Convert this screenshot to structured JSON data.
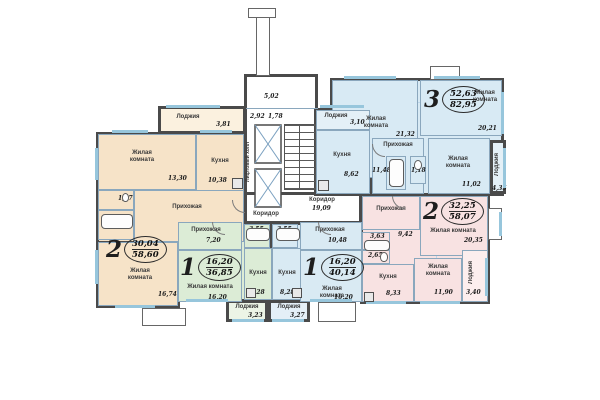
{
  "core": {
    "lift_hall_label": "Лифтовый холл",
    "corridor_left_label": "Коридор",
    "corridor_right_label": "Коридор",
    "corridor_right_area": "19,09",
    "tambour_dims": [
      "5,02",
      "2,92",
      "1,78"
    ]
  },
  "apartments": [
    {
      "key": "orange-2room",
      "badge": "2",
      "living_area": "30,04",
      "total_area": "58,60",
      "rooms": [
        {
          "label": "Лоджия",
          "area": "3,81"
        },
        {
          "label": "Жилая комната",
          "area": "13,30"
        },
        {
          "label": "Кухня",
          "area": "10,38"
        },
        {
          "label": "",
          "area": "1,67"
        },
        {
          "label": "",
          "area": "2,48"
        },
        {
          "label": "Прихожая",
          "area": "11,80"
        },
        {
          "label": "Жилая комната",
          "area": "16,74"
        }
      ]
    },
    {
      "key": "green-1room",
      "badge": "1",
      "living_area": "16,20",
      "total_area": "36,85",
      "rooms": [
        {
          "label": "Прихожая",
          "area": "7,20"
        },
        {
          "label": "Жилая комната",
          "area": "16,20"
        },
        {
          "label": "",
          "area": "3,55"
        },
        {
          "label": "Кухня",
          "area": "8,28"
        },
        {
          "label": "Лоджия",
          "area": "3,23"
        }
      ]
    },
    {
      "key": "blue-1room",
      "badge": "1",
      "living_area": "16,20",
      "total_area": "40,14",
      "rooms": [
        {
          "label": "Прихожая",
          "area": "10,48"
        },
        {
          "label": "Жилая комната",
          "area": "16,20"
        },
        {
          "label": "",
          "area": "3,55"
        },
        {
          "label": "Кухня",
          "area": "8,28"
        },
        {
          "label": "Лоджия",
          "area": "3,27"
        }
      ]
    },
    {
      "key": "top-3room",
      "badge": "3",
      "living_area": "52,63",
      "total_area": "82,95",
      "rooms": [
        {
          "label": "Жилая комната",
          "area": "21,32"
        },
        {
          "label": "Жилая комната",
          "area": "20,21"
        },
        {
          "label": "Жилая комната",
          "area": "11,02"
        },
        {
          "label": "Кухня",
          "area": "8,62"
        },
        {
          "label": "Прихожая",
          "area": "11,48"
        },
        {
          "label": "",
          "area": "4,08"
        },
        {
          "label": "",
          "area": "1,18"
        },
        {
          "label": "Лоджия",
          "area": "3,10"
        },
        {
          "label": "Лоджия",
          "area": "4,35"
        }
      ]
    },
    {
      "key": "pink-2room",
      "badge": "2",
      "living_area": "32,25",
      "total_area": "58,07",
      "rooms": [
        {
          "label": "Прихожая",
          "area": "9,42"
        },
        {
          "label": "Жилая комната",
          "area": "20,35"
        },
        {
          "label": "Жилая комната",
          "area": "11,90"
        },
        {
          "label": "Кухня",
          "area": "8,33"
        },
        {
          "label": "",
          "area": "3,63"
        },
        {
          "label": "",
          "area": "2,65"
        },
        {
          "label": "Лоджия",
          "area": "3,40"
        }
      ]
    }
  ]
}
